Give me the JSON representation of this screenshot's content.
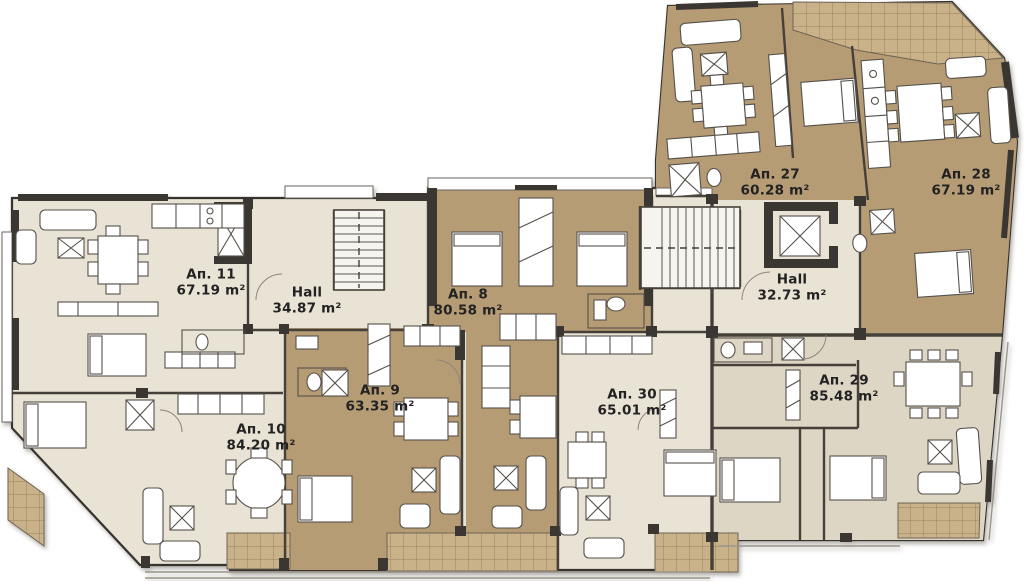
{
  "plan_title": "Floor plan",
  "rooms": [
    {
      "id": "ap11",
      "label": "Ап. 11",
      "area": "67.19 m²"
    },
    {
      "id": "hall-left",
      "label": "Hall",
      "area": "34.87 m²"
    },
    {
      "id": "ap8",
      "label": "Ап. 8",
      "area": "80.58 m²"
    },
    {
      "id": "ap9",
      "label": "Ап. 9",
      "area": "63.35 m²"
    },
    {
      "id": "ap10",
      "label": "Ап. 10",
      "area": "84.20 m²"
    },
    {
      "id": "ap30",
      "label": "Ап. 30",
      "area": "65.01 m²"
    },
    {
      "id": "ap27",
      "label": "Ап. 27",
      "area": "60.28 m²"
    },
    {
      "id": "ap28",
      "label": "Ап. 28",
      "area": "67.19 m²"
    },
    {
      "id": "hall-right",
      "label": "Hall",
      "area": "32.73 m²"
    },
    {
      "id": "ap29",
      "label": "Ап. 29",
      "area": "85.48 m²"
    }
  ],
  "colors": {
    "apartment_tan": "#b69c74",
    "common_cream": "#e9e3d5",
    "apartment_greige": "#ded6c5",
    "terrace_tan": "#c9b289",
    "wall_dark": "#3a3631",
    "background": "#ffffff"
  }
}
